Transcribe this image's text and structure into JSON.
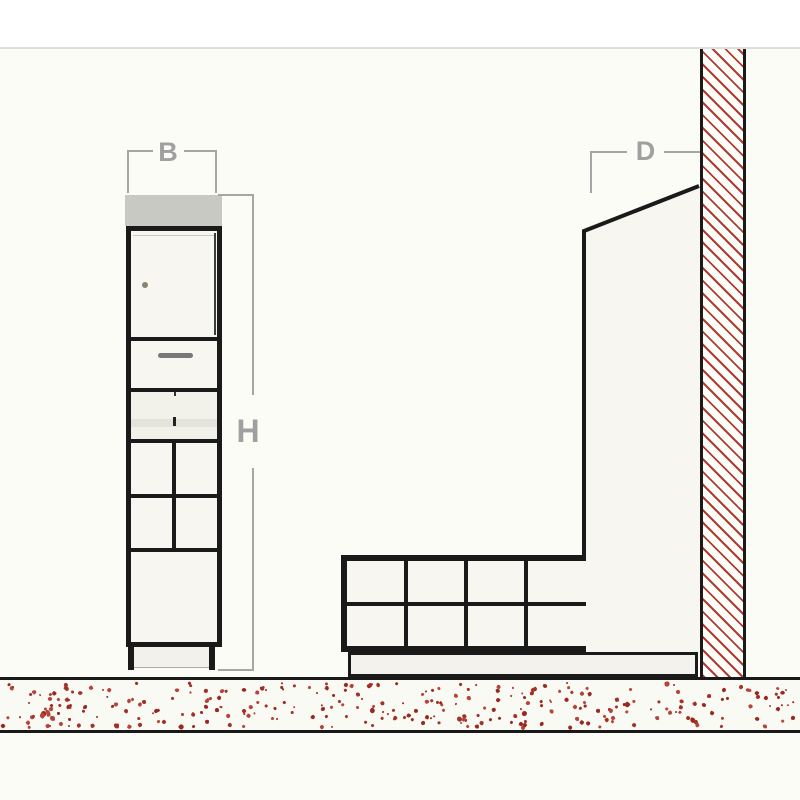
{
  "labels": {
    "width": "B",
    "height": "H",
    "depth": "D"
  },
  "colors": {
    "background": "#FCFCF6",
    "top_strip": "#FFFFFF",
    "outline": "#1A1A1A",
    "cabinet_fill": "#F7F6F0",
    "countertop_gray": "#C9C9C3",
    "dimension_gray": "#A6A6A6",
    "hatch_red": "#B23B31",
    "ground_fill": "#FAFAF4"
  },
  "ground_texture": {
    "speckle_count": 300,
    "seed": 7,
    "speckle_colors": [
      "#99291F",
      "#B5443A",
      "#A03228"
    ]
  }
}
